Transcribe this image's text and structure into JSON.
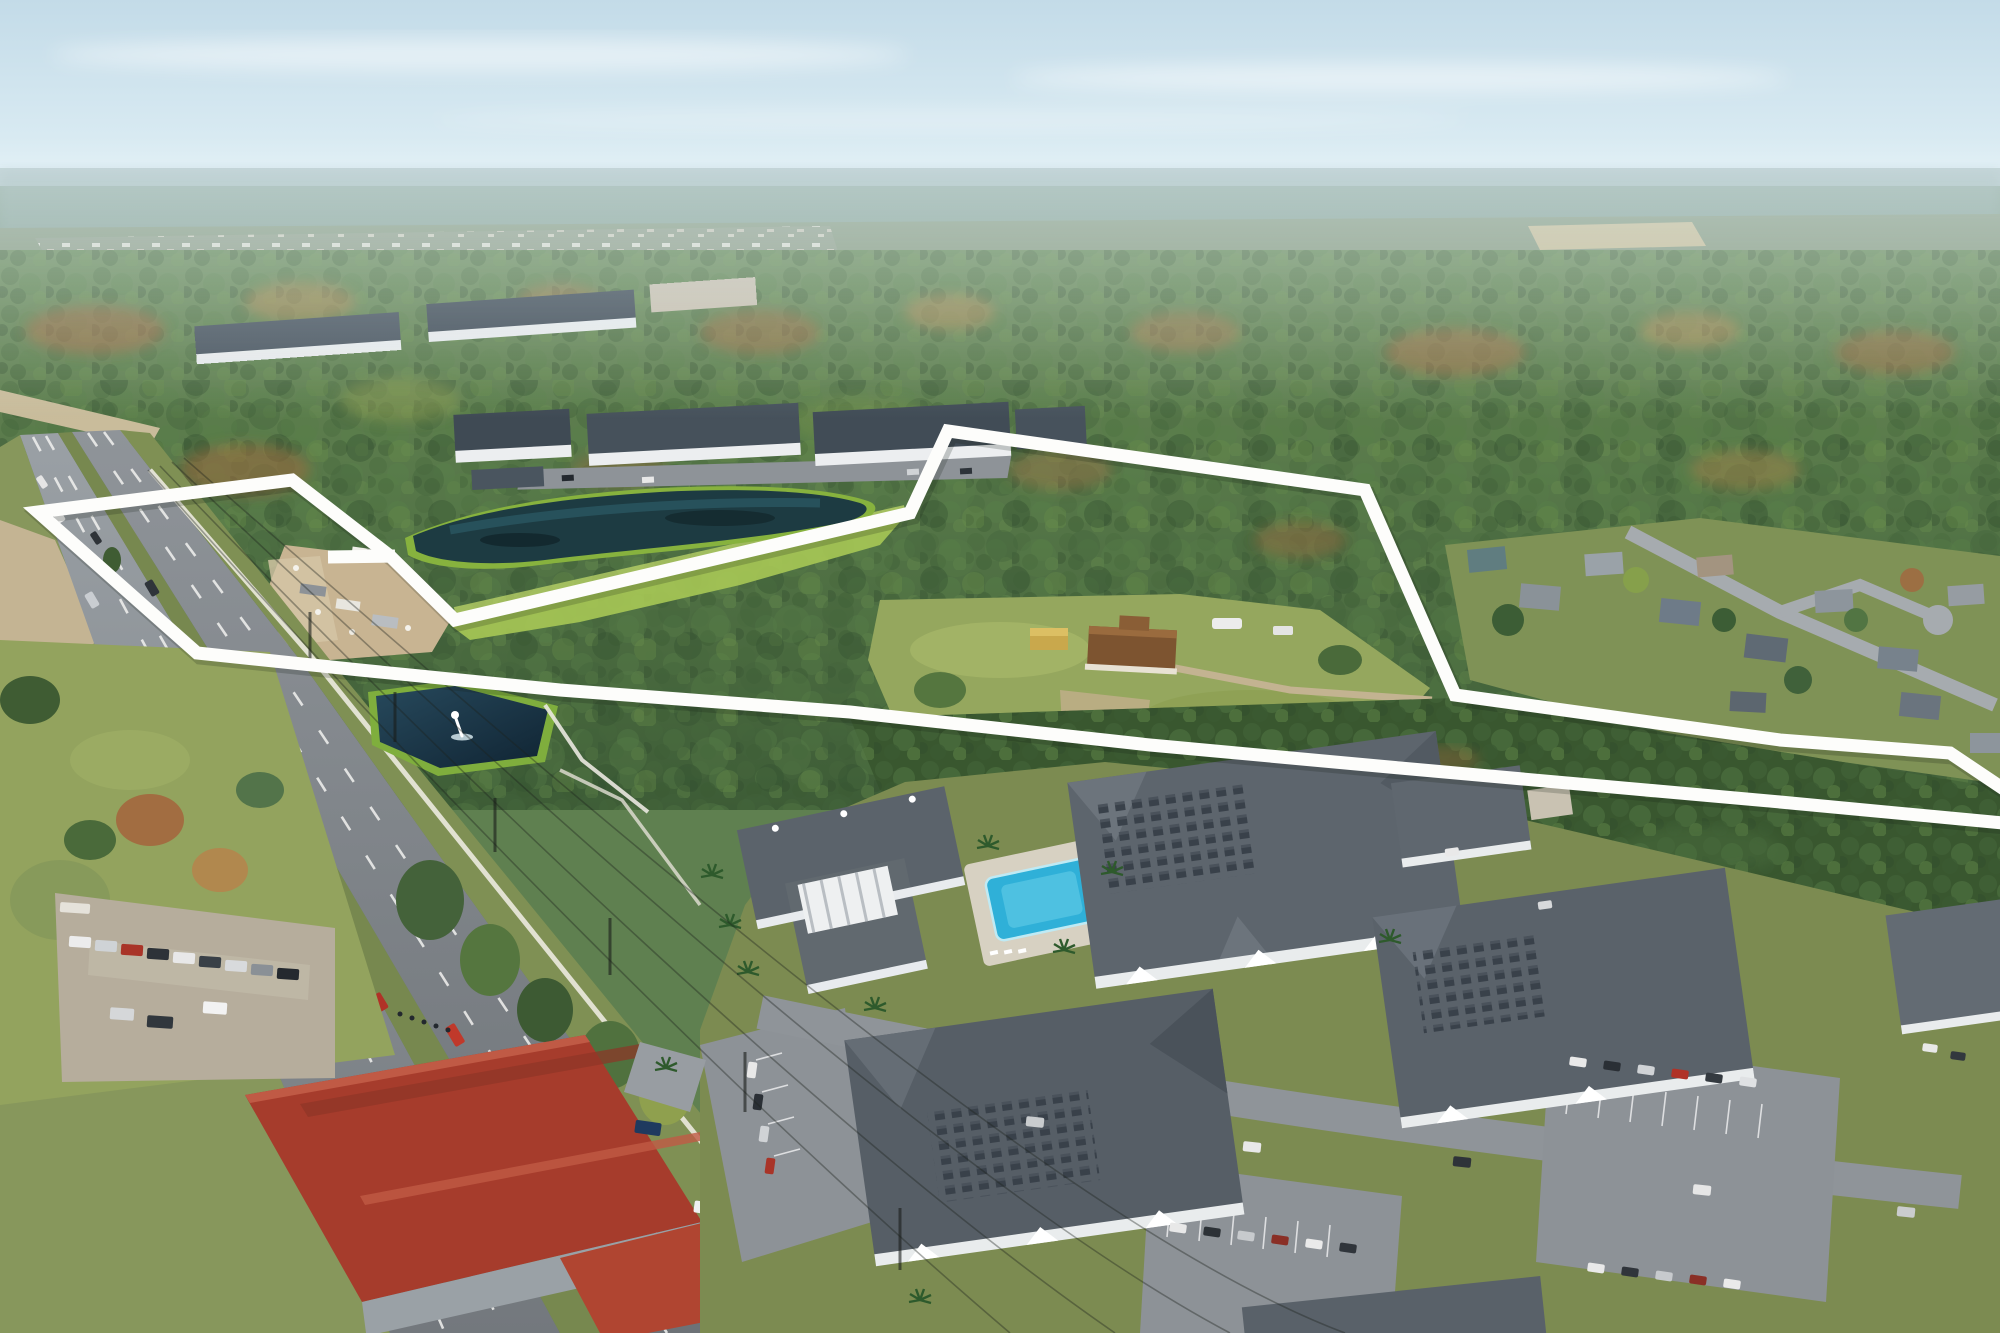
{
  "meta": {
    "description": "Oblique aerial drone photograph of a vacant wooded land parcel outlined in white, located along a six-lane divided highway, surrounded by apartment complexes, retention ponds, a red-roofed warehouse and suburban neighborhoods",
    "visible_text": "none"
  },
  "boundary": {
    "label": "property-line-overlay",
    "stroke_color": "#fdfdfb",
    "stroke_width": 13,
    "closed": true,
    "main_points": [
      [
        38,
        512
      ],
      [
        292,
        480
      ],
      [
        390,
        556
      ],
      [
        455,
        620
      ],
      [
        910,
        513
      ],
      [
        948,
        431
      ],
      [
        1365,
        490
      ],
      [
        1455,
        695
      ],
      [
        1780,
        740
      ],
      [
        1950,
        753
      ],
      [
        2035,
        810
      ],
      [
        2035,
        826
      ],
      [
        1780,
        802
      ],
      [
        1400,
        768
      ],
      [
        1150,
        745
      ],
      [
        850,
        712
      ],
      [
        560,
        690
      ],
      [
        360,
        670
      ],
      [
        197,
        653
      ]
    ],
    "spur_points": [
      [
        328,
        557
      ],
      [
        395,
        556
      ]
    ]
  },
  "palette": {
    "boundary": "#fdfdfb",
    "sky": "#cde2ec",
    "forest_green": "#4e7042",
    "autumn_rust": "#a4673e",
    "asphalt": "#84898e",
    "pond_water": "#1d3b4a",
    "pool_water": "#35b3d6",
    "warehouse_roof": "#a63c2c",
    "grass": "#8fa05a",
    "building_wall": "#e9ecef",
    "building_roof": "#5b636b"
  }
}
